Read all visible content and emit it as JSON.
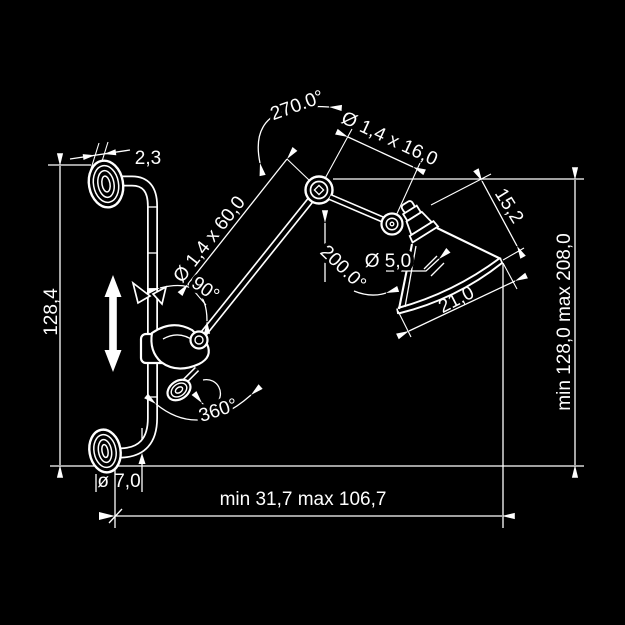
{
  "drawing": {
    "type": "technical-dimension-drawing",
    "subject": "articulated wall lamp",
    "colors": {
      "background": "#000000",
      "line": "#ffffff"
    },
    "labels": {
      "flange_thickness": "2,3",
      "left_height": "128,4",
      "elbow_rotation": "270.0°",
      "forearm_tube": "Ø 1,4 x 16,0",
      "upper_arm_tube": "Ø 1,4 x 60,0",
      "shade_height": "15,2",
      "socket_diameter": "Ø 5,0",
      "shade_rotation": "200.0°",
      "arm_angle": "90°",
      "shade_diameter": "21,0",
      "right_height": "min 128,0  max 208,0",
      "base_rotation": "360°",
      "tube_diameter": "ø 7,0",
      "horizontal_reach": "min 31,7   max 106,7"
    }
  }
}
